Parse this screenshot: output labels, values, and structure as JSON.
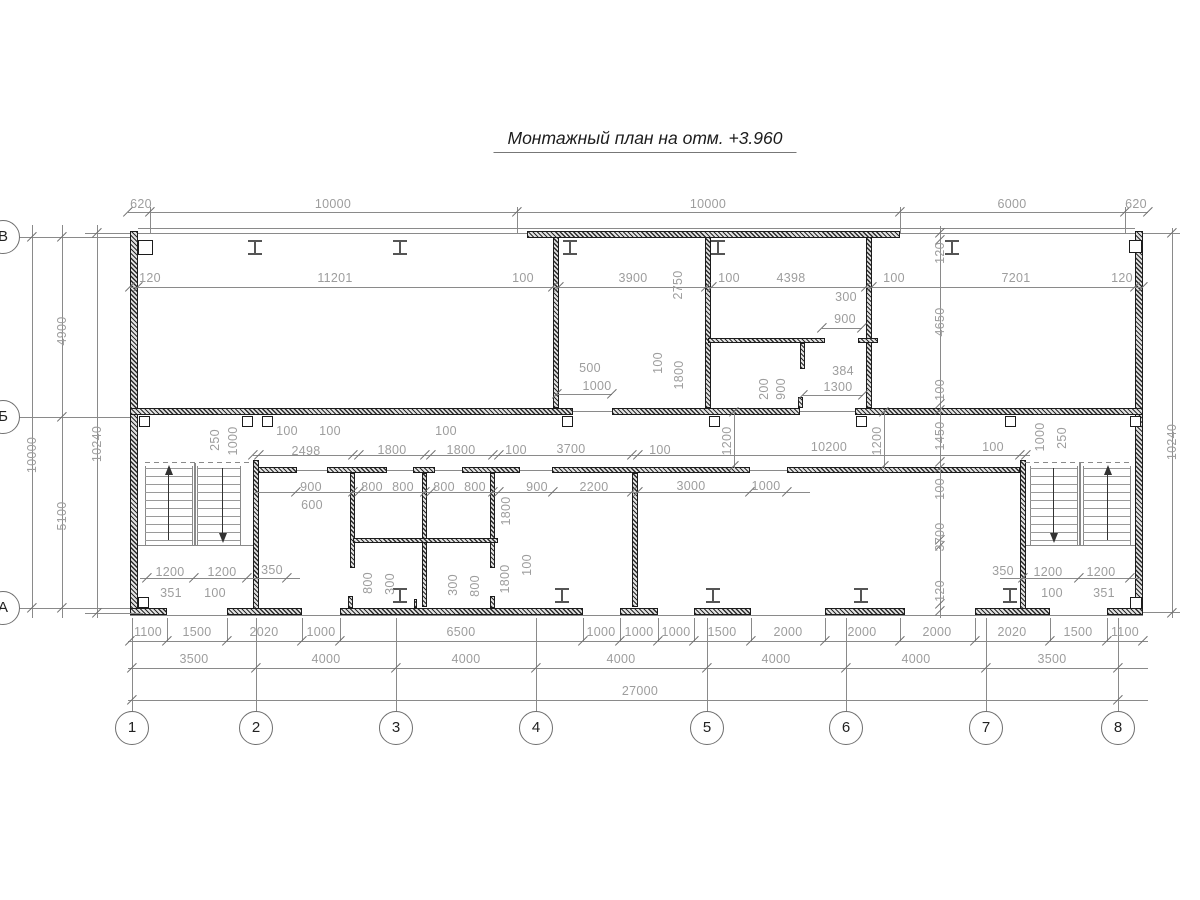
{
  "title": "Монтажный план на отм. +3.960",
  "title_pos": {
    "x": 645,
    "y": 128
  },
  "colors": {
    "wall": "#1c1c1c",
    "line": "#8a8a8a",
    "dim_text": "#9d9d9d"
  },
  "axes": {
    "cols": [
      {
        "label": "1",
        "x": 132
      },
      {
        "label": "2",
        "x": 256
      },
      {
        "label": "3",
        "x": 396
      },
      {
        "label": "4",
        "x": 536
      },
      {
        "label": "5",
        "x": 707
      },
      {
        "label": "6",
        "x": 846
      },
      {
        "label": "7",
        "x": 986
      },
      {
        "label": "8",
        "x": 1118
      }
    ],
    "col_circle_y": 728,
    "rows": [
      {
        "label": "В",
        "y": 237
      },
      {
        "label": "Б",
        "y": 417
      },
      {
        "label": "А",
        "y": 608
      }
    ],
    "row_circle_x": 3
  },
  "walls": [
    [
      130,
      231,
      8,
      382
    ],
    [
      1135,
      231,
      8,
      382
    ],
    [
      527,
      231,
      373,
      7
    ],
    [
      130,
      408,
      443,
      7
    ],
    [
      612,
      408,
      188,
      7
    ],
    [
      855,
      408,
      288,
      7
    ],
    [
      553,
      237,
      6,
      171
    ],
    [
      705,
      237,
      6,
      171
    ],
    [
      866,
      237,
      6,
      171
    ],
    [
      708,
      338,
      117,
      5
    ],
    [
      858,
      338,
      20,
      5
    ],
    [
      800,
      343,
      5,
      26
    ],
    [
      798,
      397,
      5,
      11
    ],
    [
      258,
      467,
      39,
      6
    ],
    [
      327,
      467,
      60,
      6
    ],
    [
      413,
      467,
      22,
      6
    ],
    [
      462,
      467,
      58,
      6
    ],
    [
      552,
      467,
      198,
      6
    ],
    [
      787,
      467,
      233,
      6
    ],
    [
      350,
      473,
      5,
      95
    ],
    [
      422,
      473,
      5,
      134
    ],
    [
      490,
      473,
      5,
      95
    ],
    [
      353,
      538,
      145,
      5
    ],
    [
      632,
      473,
      6,
      134
    ],
    [
      348,
      596,
      5,
      12
    ],
    [
      490,
      596,
      5,
      12
    ],
    [
      414,
      599,
      3,
      9
    ],
    [
      253,
      460,
      6,
      153
    ],
    [
      1020,
      460,
      6,
      153
    ],
    [
      130,
      608,
      37,
      7
    ],
    [
      227,
      608,
      75,
      7
    ],
    [
      340,
      608,
      243,
      7
    ],
    [
      620,
      608,
      38,
      7
    ],
    [
      694,
      608,
      57,
      7
    ],
    [
      825,
      608,
      80,
      7
    ],
    [
      975,
      608,
      75,
      7
    ],
    [
      1107,
      608,
      36,
      7
    ]
  ],
  "lines": [
    [
      138,
      228,
      997,
      1
    ],
    [
      138,
      233,
      389,
      1
    ],
    [
      900,
      233,
      235,
      1
    ],
    [
      130,
      615,
      1013,
      1
    ],
    [
      128,
      212,
      1020,
      1
    ],
    [
      130,
      287,
      1013,
      1
    ],
    [
      557,
      394,
      55,
      1
    ],
    [
      822,
      328,
      40,
      1
    ],
    [
      803,
      395,
      60,
      1
    ],
    [
      253,
      455,
      777,
      1
    ],
    [
      255,
      492,
      555,
      1
    ],
    [
      128,
      641,
      1020,
      1
    ],
    [
      128,
      668,
      1020,
      1
    ],
    [
      128,
      700,
      1020,
      1
    ],
    [
      140,
      578,
      160,
      1
    ],
    [
      1000,
      578,
      140,
      1
    ],
    [
      32,
      225,
      1,
      393
    ],
    [
      62,
      225,
      1,
      393
    ],
    [
      97,
      225,
      1,
      393
    ],
    [
      940,
      226,
      1,
      392
    ],
    [
      1172,
      228,
      1,
      390
    ],
    [
      734,
      410,
      1,
      58
    ],
    [
      884,
      410,
      1,
      58
    ],
    [
      19,
      237,
      111,
      1
    ],
    [
      19,
      417,
      111,
      1
    ],
    [
      19,
      608,
      111,
      1
    ],
    [
      1143,
      233,
      37,
      1
    ],
    [
      1143,
      612,
      37,
      1
    ],
    [
      85,
      233,
      45,
      1
    ],
    [
      85,
      613,
      58,
      1
    ],
    [
      150,
      207,
      1,
      26
    ],
    [
      517,
      207,
      1,
      26
    ],
    [
      900,
      207,
      1,
      26
    ],
    [
      1125,
      207,
      1,
      26
    ],
    [
      132,
      618,
      1,
      94
    ],
    [
      256,
      618,
      1,
      94
    ],
    [
      396,
      618,
      1,
      94
    ],
    [
      536,
      618,
      1,
      94
    ],
    [
      707,
      618,
      1,
      94
    ],
    [
      846,
      618,
      1,
      94
    ],
    [
      986,
      618,
      1,
      94
    ],
    [
      1118,
      618,
      1,
      94
    ],
    [
      167,
      618,
      1,
      23
    ],
    [
      227,
      618,
      1,
      23
    ],
    [
      302,
      618,
      1,
      23
    ],
    [
      340,
      618,
      1,
      23
    ],
    [
      583,
      618,
      1,
      23
    ],
    [
      620,
      618,
      1,
      23
    ],
    [
      658,
      618,
      1,
      23
    ],
    [
      694,
      618,
      1,
      23
    ],
    [
      751,
      618,
      1,
      23
    ],
    [
      825,
      618,
      1,
      23
    ],
    [
      900,
      618,
      1,
      23
    ],
    [
      975,
      618,
      1,
      23
    ],
    [
      1050,
      618,
      1,
      23
    ],
    [
      1107,
      618,
      1,
      23
    ],
    [
      138,
      545,
      115,
      1
    ],
    [
      1026,
      545,
      109,
      1
    ],
    [
      145,
      466,
      1,
      79
    ],
    [
      192,
      466,
      1,
      79
    ],
    [
      197,
      466,
      1,
      79
    ],
    [
      240,
      466,
      1,
      79
    ],
    [
      194,
      463,
      2,
      82
    ],
    [
      1030,
      466,
      1,
      79
    ],
    [
      1077,
      466,
      1,
      79
    ],
    [
      1083,
      466,
      1,
      79
    ],
    [
      1130,
      466,
      1,
      79
    ],
    [
      1079,
      463,
      2,
      82
    ],
    [
      573,
      411,
      39,
      1
    ],
    [
      800,
      411,
      55,
      1
    ],
    [
      297,
      470,
      30,
      1
    ],
    [
      387,
      470,
      26,
      1
    ],
    [
      435,
      470,
      27,
      1
    ],
    [
      520,
      470,
      32,
      1
    ],
    [
      750,
      470,
      37,
      1
    ]
  ],
  "dashes": [
    [
      145,
      462,
      105
    ],
    [
      1025,
      462,
      105
    ]
  ],
  "squares": [
    [
      138,
      240,
      15
    ],
    [
      1129,
      240,
      13
    ],
    [
      138,
      597,
      11
    ],
    [
      1130,
      597,
      12
    ],
    [
      139,
      416,
      11
    ],
    [
      242,
      416,
      11
    ],
    [
      262,
      416,
      11
    ],
    [
      562,
      416,
      11
    ],
    [
      709,
      416,
      11
    ],
    [
      856,
      416,
      11
    ],
    [
      1005,
      416,
      11
    ],
    [
      1130,
      416,
      11
    ]
  ],
  "ibeams": [
    [
      255,
      240
    ],
    [
      400,
      240
    ],
    [
      570,
      240
    ],
    [
      718,
      240
    ],
    [
      952,
      240
    ],
    [
      400,
      588
    ],
    [
      562,
      588
    ],
    [
      713,
      588
    ],
    [
      861,
      588
    ],
    [
      1010,
      588
    ]
  ],
  "ticks": [
    [
      128,
      212
    ],
    [
      150,
      212
    ],
    [
      517,
      212
    ],
    [
      900,
      212
    ],
    [
      1125,
      212
    ],
    [
      1148,
      212
    ],
    [
      130,
      287
    ],
    [
      138,
      287
    ],
    [
      553,
      287
    ],
    [
      559,
      287
    ],
    [
      706,
      287
    ],
    [
      712,
      287
    ],
    [
      866,
      287
    ],
    [
      872,
      287
    ],
    [
      1135,
      287
    ],
    [
      1143,
      287
    ],
    [
      557,
      394
    ],
    [
      612,
      394
    ],
    [
      822,
      328
    ],
    [
      862,
      328
    ],
    [
      803,
      395
    ],
    [
      863,
      395
    ],
    [
      253,
      455
    ],
    [
      259,
      455
    ],
    [
      353,
      455
    ],
    [
      359,
      455
    ],
    [
      425,
      455
    ],
    [
      431,
      455
    ],
    [
      493,
      455
    ],
    [
      499,
      455
    ],
    [
      632,
      455
    ],
    [
      638,
      455
    ],
    [
      1020,
      455
    ],
    [
      1026,
      455
    ],
    [
      296,
      492
    ],
    [
      353,
      492
    ],
    [
      359,
      492
    ],
    [
      425,
      492
    ],
    [
      431,
      492
    ],
    [
      493,
      492
    ],
    [
      499,
      492
    ],
    [
      553,
      492
    ],
    [
      632,
      492
    ],
    [
      638,
      492
    ],
    [
      750,
      492
    ],
    [
      787,
      492
    ],
    [
      130,
      641
    ],
    [
      167,
      641
    ],
    [
      227,
      641
    ],
    [
      302,
      641
    ],
    [
      340,
      641
    ],
    [
      583,
      641
    ],
    [
      620,
      641
    ],
    [
      658,
      641
    ],
    [
      694,
      641
    ],
    [
      751,
      641
    ],
    [
      825,
      641
    ],
    [
      900,
      641
    ],
    [
      975,
      641
    ],
    [
      1050,
      641
    ],
    [
      1107,
      641
    ],
    [
      1143,
      641
    ],
    [
      132,
      668
    ],
    [
      256,
      668
    ],
    [
      396,
      668
    ],
    [
      536,
      668
    ],
    [
      707,
      668
    ],
    [
      846,
      668
    ],
    [
      986,
      668
    ],
    [
      1118,
      668
    ],
    [
      132,
      700
    ],
    [
      1118,
      700
    ],
    [
      32,
      237
    ],
    [
      32,
      608
    ],
    [
      62,
      237
    ],
    [
      62,
      417
    ],
    [
      62,
      608
    ],
    [
      97,
      233
    ],
    [
      97,
      613
    ],
    [
      940,
      233
    ],
    [
      940,
      240
    ],
    [
      940,
      404
    ],
    [
      940,
      410
    ],
    [
      940,
      462
    ],
    [
      940,
      468
    ],
    [
      940,
      540
    ],
    [
      940,
      546
    ],
    [
      940,
      604
    ],
    [
      940,
      611
    ],
    [
      1172,
      233
    ],
    [
      1172,
      613
    ],
    [
      734,
      412
    ],
    [
      734,
      466
    ],
    [
      884,
      412
    ],
    [
      884,
      466
    ],
    [
      147,
      578
    ],
    [
      194,
      578
    ],
    [
      247,
      578
    ],
    [
      287,
      578
    ],
    [
      1023,
      578
    ],
    [
      1079,
      578
    ],
    [
      1130,
      578
    ]
  ],
  "dims": [
    [
      "620",
      141,
      204,
      0
    ],
    [
      "10000",
      333,
      204,
      0
    ],
    [
      "10000",
      708,
      204,
      0
    ],
    [
      "6000",
      1012,
      204,
      0
    ],
    [
      "620",
      1136,
      204,
      0
    ],
    [
      "120",
      150,
      278,
      0
    ],
    [
      "11201",
      335,
      278,
      0
    ],
    [
      "100",
      523,
      278,
      0
    ],
    [
      "3900",
      633,
      278,
      0
    ],
    [
      "100",
      729,
      278,
      0
    ],
    [
      "4398",
      791,
      278,
      0
    ],
    [
      "100",
      894,
      278,
      0
    ],
    [
      "7201",
      1016,
      278,
      0
    ],
    [
      "120",
      1122,
      278,
      0
    ],
    [
      "2750",
      678,
      285,
      1
    ],
    [
      "500",
      590,
      368,
      0
    ],
    [
      "1000",
      597,
      386,
      0
    ],
    [
      "100",
      658,
      363,
      1
    ],
    [
      "1800",
      679,
      375,
      1
    ],
    [
      "300",
      846,
      297,
      0
    ],
    [
      "900",
      845,
      319,
      0
    ],
    [
      "200",
      764,
      389,
      1
    ],
    [
      "900",
      781,
      389,
      1
    ],
    [
      "384",
      843,
      371,
      0
    ],
    [
      "1300",
      838,
      387,
      0
    ],
    [
      "120",
      940,
      253,
      1
    ],
    [
      "4650",
      940,
      322,
      1
    ],
    [
      "100",
      940,
      390,
      1
    ],
    [
      "1450",
      940,
      436,
      1
    ],
    [
      "100",
      940,
      489,
      1
    ],
    [
      "3700",
      940,
      537,
      1
    ],
    [
      "120",
      940,
      591,
      1
    ],
    [
      "10240",
      1172,
      442,
      1
    ],
    [
      "10000",
      32,
      455,
      1
    ],
    [
      "4900",
      62,
      331,
      1
    ],
    [
      "5100",
      62,
      516,
      1
    ],
    [
      "10240",
      97,
      444,
      1
    ],
    [
      "100",
      287,
      431,
      0
    ],
    [
      "100",
      330,
      431,
      0
    ],
    [
      "2498",
      306,
      451,
      0
    ],
    [
      "1800",
      392,
      450,
      0
    ],
    [
      "100",
      446,
      431,
      0
    ],
    [
      "1800",
      461,
      450,
      0
    ],
    [
      "100",
      516,
      450,
      0
    ],
    [
      "3700",
      571,
      449,
      0
    ],
    [
      "100",
      660,
      450,
      0
    ],
    [
      "10200",
      829,
      447,
      0
    ],
    [
      "100",
      993,
      447,
      0
    ],
    [
      "1200",
      727,
      441,
      1
    ],
    [
      "1200",
      877,
      441,
      1
    ],
    [
      "250",
      215,
      440,
      1
    ],
    [
      "1000",
      233,
      441,
      1
    ],
    [
      "1000",
      1040,
      437,
      1
    ],
    [
      "250",
      1062,
      438,
      1
    ],
    [
      "900",
      311,
      487,
      0
    ],
    [
      "600",
      312,
      505,
      0
    ],
    [
      "800",
      372,
      487,
      0
    ],
    [
      "800",
      403,
      487,
      0
    ],
    [
      "800",
      444,
      487,
      0
    ],
    [
      "800",
      475,
      487,
      0
    ],
    [
      "900",
      537,
      487,
      0
    ],
    [
      "2200",
      594,
      487,
      0
    ],
    [
      "3000",
      691,
      486,
      0
    ],
    [
      "1000",
      766,
      486,
      0
    ],
    [
      "1800",
      506,
      511,
      1
    ],
    [
      "100",
      527,
      565,
      1
    ],
    [
      "1800",
      505,
      579,
      1
    ],
    [
      "800",
      368,
      583,
      1
    ],
    [
      "300",
      390,
      584,
      1
    ],
    [
      "300",
      453,
      585,
      1
    ],
    [
      "800",
      475,
      586,
      1
    ],
    [
      "1200",
      170,
      572,
      0
    ],
    [
      "1200",
      222,
      572,
      0
    ],
    [
      "350",
      272,
      570,
      0
    ],
    [
      "351",
      171,
      593,
      0
    ],
    [
      "100",
      215,
      593,
      0
    ],
    [
      "350",
      1003,
      571,
      0
    ],
    [
      "1200",
      1048,
      572,
      0
    ],
    [
      "1200",
      1101,
      572,
      0
    ],
    [
      "100",
      1052,
      593,
      0
    ],
    [
      "351",
      1104,
      593,
      0
    ],
    [
      "1100",
      148,
      632,
      0
    ],
    [
      "1500",
      197,
      632,
      0
    ],
    [
      "2020",
      264,
      632,
      0
    ],
    [
      "1000",
      321,
      632,
      0
    ],
    [
      "6500",
      461,
      632,
      0
    ],
    [
      "1000",
      601,
      632,
      0
    ],
    [
      "1000",
      639,
      632,
      0
    ],
    [
      "1000",
      676,
      632,
      0
    ],
    [
      "1500",
      722,
      632,
      0
    ],
    [
      "2000",
      788,
      632,
      0
    ],
    [
      "2000",
      862,
      632,
      0
    ],
    [
      "2000",
      937,
      632,
      0
    ],
    [
      "2020",
      1012,
      632,
      0
    ],
    [
      "1500",
      1078,
      632,
      0
    ],
    [
      "1100",
      1125,
      632,
      0
    ],
    [
      "3500",
      194,
      659,
      0
    ],
    [
      "4000",
      326,
      659,
      0
    ],
    [
      "4000",
      466,
      659,
      0
    ],
    [
      "4000",
      621,
      659,
      0
    ],
    [
      "4000",
      776,
      659,
      0
    ],
    [
      "4000",
      916,
      659,
      0
    ],
    [
      "3500",
      1052,
      659,
      0
    ],
    [
      "27000",
      640,
      691,
      0
    ]
  ],
  "stairs": [
    {
      "x": 145,
      "w": 47,
      "y": 468,
      "h": 72,
      "arrow": "up",
      "ax": 168
    },
    {
      "x": 197,
      "w": 43,
      "y": 468,
      "h": 72,
      "arrow": "down",
      "ax": 222
    },
    {
      "x": 1030,
      "w": 47,
      "y": 468,
      "h": 72,
      "arrow": "down",
      "ax": 1053
    },
    {
      "x": 1083,
      "w": 47,
      "y": 468,
      "h": 72,
      "arrow": "up",
      "ax": 1107
    }
  ]
}
